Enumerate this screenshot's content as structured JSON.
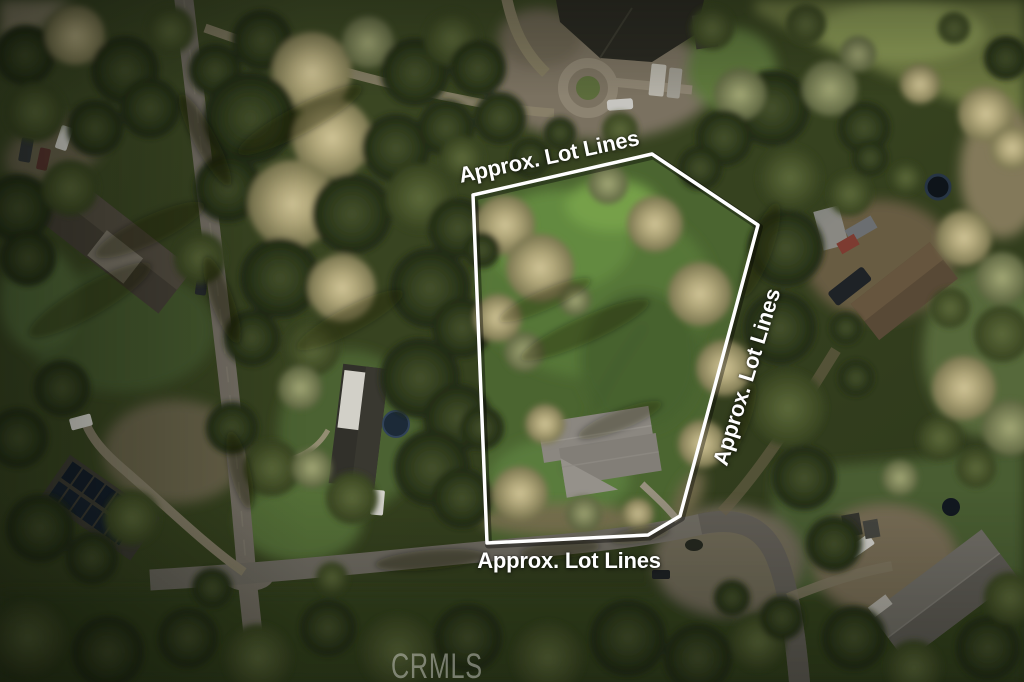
{
  "overlay": {
    "labels": {
      "top": "Approx. Lot Lines",
      "right": "Approx. Lot Lines",
      "bottom": "Approx. Lot Lines"
    },
    "lot_outline_points": "473,195 652,154 758,225 680,516 648,535 487,543",
    "outline_color": "#ffffff",
    "label_color": "#ffffff"
  },
  "watermark": {
    "text": "CRMLS",
    "color": "rgba(206,206,200,0.5)"
  },
  "scene_palette": {
    "forest_dark": "#242e16",
    "tree_khaki": "#b3a97a",
    "lot_grass": "#4b6530",
    "road_gray": "#756f65"
  }
}
